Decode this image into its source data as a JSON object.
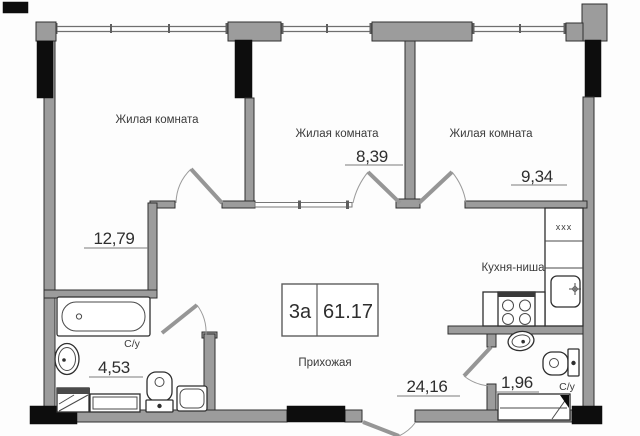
{
  "rooms": [
    {
      "label": "Жилая комната",
      "area": "12,79"
    },
    {
      "label": "Жилая комната",
      "area": "8,39"
    },
    {
      "label": "Жилая комната",
      "area": "9,34"
    }
  ],
  "kitchen": {
    "label": "Кухня-ниша"
  },
  "hallway": {
    "label": "Прихожая",
    "area": "24,16"
  },
  "bathroom": {
    "label": "С/у",
    "area": "4,53"
  },
  "wc": {
    "label": "С/у",
    "area": "1,96"
  },
  "info_box": {
    "unit": "3а",
    "total_area": "61.17"
  },
  "kitchen_vent": "xxx",
  "colors": {
    "wall_grey": "#9c9c9c",
    "column_black": "#0d0d0d",
    "line": "#2f2f2f"
  }
}
